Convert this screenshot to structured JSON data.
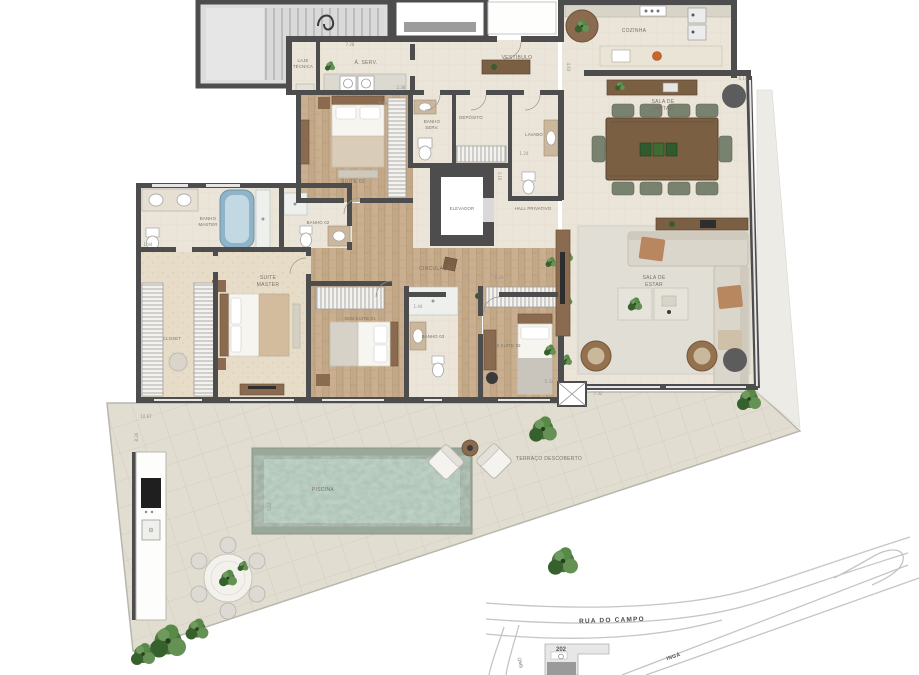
{
  "plan": {
    "rooms": {
      "laje_tecnica": {
        "l1": "LAJE",
        "l2": "TÉCNICA"
      },
      "area_servico": "Á. SERV.",
      "vestibulo": "VESTIBULO",
      "cozinha": "COZINHA",
      "sala_jantar": {
        "l1": "SALA DE",
        "l2": "JANTAR"
      },
      "banho_serv": {
        "l1": "BANHO",
        "l2": "SERV."
      },
      "deposito": "DEPÓSITO",
      "lavabo": "LAVABO",
      "suite_02": "SUITE 02",
      "elevador": "ELEVADOR",
      "hall_privativo": "HALL PRIVATIVO",
      "circulacao": "CIRCULAÇÃO",
      "banho_master": {
        "l1": "BANHO",
        "l2": "MASTER"
      },
      "banho_02": "BANHO 02",
      "suite_master": {
        "l1": "SUITE",
        "l2": "MASTER"
      },
      "closet": "CLOSET",
      "semi_suite_01": "SEM SUITE 01",
      "banho_03": "BANHO 03",
      "semi_suite_02": "SEM SUITE 02",
      "sala_estar": {
        "l1": "SALA DE",
        "l2": "ESTAR"
      },
      "terraco": "TERRAÇO DESCOBERTO",
      "piscina": "PISCINA"
    },
    "dimensions": [
      "7.28",
      "2.38",
      "1.94",
      "5.98",
      "4.63",
      "6.10",
      "1.24",
      "3.16",
      "6.26",
      "1.44",
      "5.32",
      "7.32",
      "10.67",
      "8.26",
      "5.62"
    ]
  },
  "site_map": {
    "street_main": "RUA DO CAMPO",
    "building_number": "202",
    "street_left": "(166)",
    "street_diagonal": "INGÁ"
  },
  "colors": {
    "wall": "#4d4d4d",
    "floor_tile": "#ebe5d9",
    "wood_floor": "#c8ae8e",
    "terrace_tile": "#e2ddd1",
    "pool_water": "#a9c0b1",
    "pool_deck": "#9aa89a",
    "plant_green": "#4e7340",
    "furniture_wood": "#7b5f43",
    "chair_green": "#79816f"
  }
}
